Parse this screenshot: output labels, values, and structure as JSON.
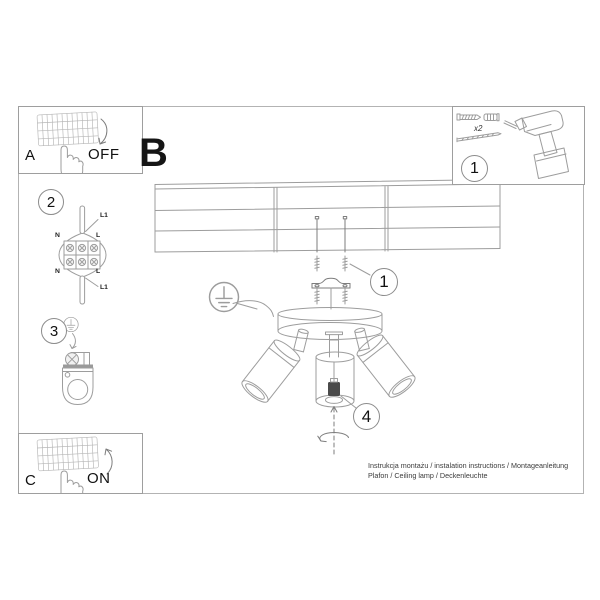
{
  "labels": {
    "panel_a": "A",
    "panel_b": "B",
    "panel_c": "C",
    "off": "OFF",
    "on": "ON",
    "x2": "x2"
  },
  "steps": {
    "kit_badge": "1",
    "mount_badge": "1",
    "wiring_badge": "2",
    "ground_badge": "3",
    "bulb_badge": "4"
  },
  "wiring_labels": {
    "l1_top": "L1",
    "n_top": "N",
    "l_top": "L",
    "n_bottom": "N",
    "l_bottom": "L",
    "l1_bottom": "L1"
  },
  "footer": {
    "line1": "Instrukcja montażu / instalation instructions / Montageanleitung",
    "line2": "Plafon / Ceiling lamp / Deckenleuchte"
  },
  "colors": {
    "background": "#ffffff",
    "line_art": "#9d9d9d",
    "dark_line": "#7d7d7d",
    "panel_border": "#9e9e9e",
    "text": "#111111",
    "footer_text": "#3b3b3b",
    "socket_fill": "#4a4a4a"
  },
  "icons": {
    "light-switch-icon": "hatched rocker wall switch",
    "pressing-hand-icon": "hand outline pressing switch",
    "arrow-down-icon": "curved arrow (switch off)",
    "arrow-up-icon": "curved arrow (switch on)",
    "wall-plug-and-screw-icon": "expansion plug with screw",
    "long-screw-icon": "long mounting screw",
    "drill-icon": "cordless drill outline",
    "ground-symbol-icon": "earth symbol in circle",
    "terminal-block-icon": "3-pole terminal block with cables",
    "ceiling-panels-icon": "panel ceiling grid",
    "expansion-screws-icon": "screws into ceiling",
    "mounting-bracket-icon": "metal mounting strap",
    "canopy-icon": "round ceiling canopy",
    "spotlight-icon": "cylindrical spot head",
    "gu10-socket-icon": "bulb socket inside glass",
    "rotation-arrow-icon": "screw-in rotation arrow"
  }
}
